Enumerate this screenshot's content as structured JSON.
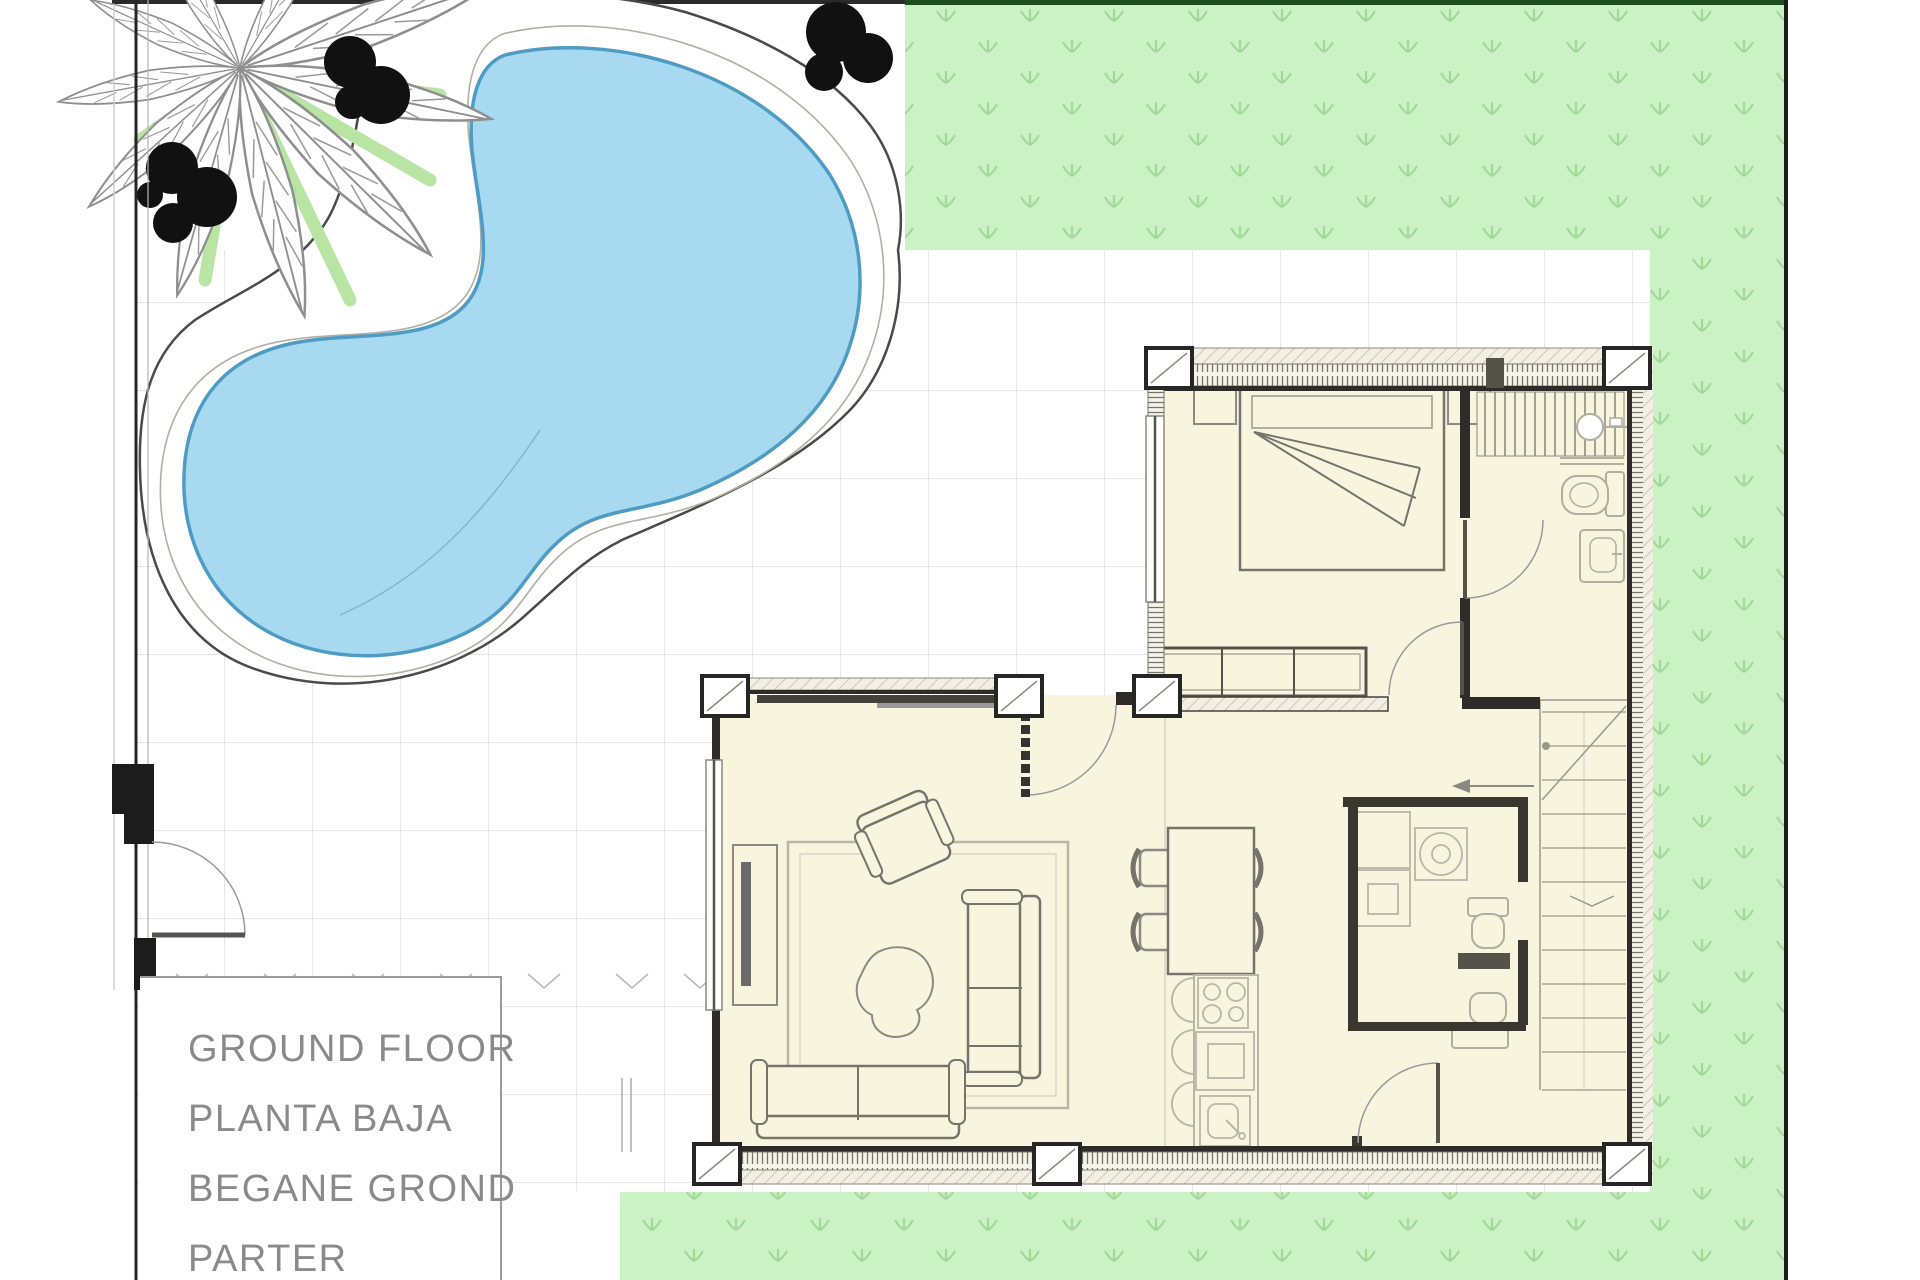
{
  "title_block": {
    "lines": [
      "GROUND FLOOR",
      "PLANTA BAJA",
      "BEGANE GROND",
      "PARTER"
    ]
  },
  "colors": {
    "pool_water": "#a7d9f0",
    "pool_water_edge": "#4e9cc4",
    "deck_outline": "#4a4a4a",
    "grass": "#caf2c4",
    "grass_symbol": "#a3d89b",
    "grass_top_border": "#1e4d1e",
    "plot_boundary": "#1c1c1c",
    "tile_line": "#dedede",
    "floor": "#f8f5de",
    "wall_dark": "#2e2b28",
    "wall_hatch": "#b9b5a8",
    "furniture_stroke": "#76736a",
    "furniture_light": "#b9b5a8",
    "label_text": "#8a8a8a",
    "shrub": "#111111",
    "palm_frond": "#8f8f8f",
    "palm_green": "#b8e5a3",
    "palm_dark_green": "#2e7d32"
  }
}
